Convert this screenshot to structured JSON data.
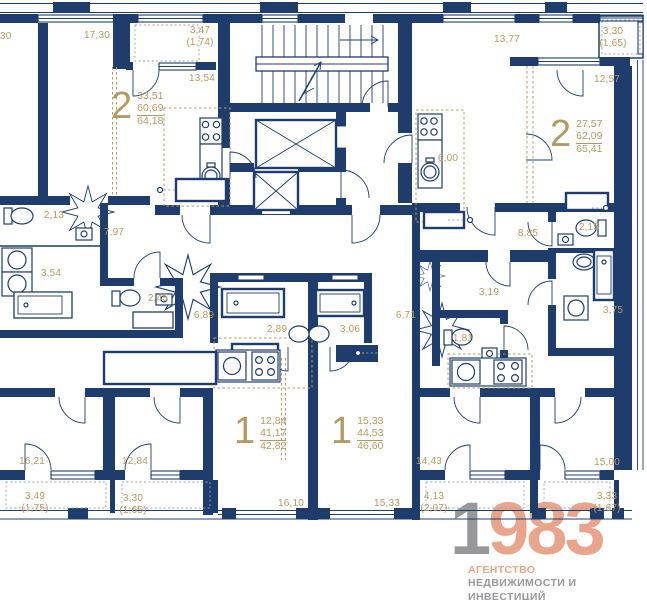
{
  "colors": {
    "wall": "#1e3c6c",
    "dim_label": "#b49a62",
    "logo_accent": "#e9a58c",
    "logo_gray": "#98989a"
  },
  "apartments": [
    {
      "rooms": "2",
      "living": "33,51",
      "area": "60,69",
      "total": "64,18"
    },
    {
      "rooms": "2",
      "living": "27,57",
      "area": "62,09",
      "total": "65,41"
    },
    {
      "rooms": "1",
      "living": "12,84",
      "area": "41,17",
      "total": "42,82"
    },
    {
      "rooms": "1",
      "living": "15,33",
      "area": "44,53",
      "total": "46,60"
    }
  ],
  "dims": [
    {
      "t": "30"
    },
    {
      "t": "17,30"
    },
    {
      "t": "3,47"
    },
    {
      "t": "(1,74)"
    },
    {
      "t": "13,54"
    },
    {
      "t": "13,77"
    },
    {
      "t": "3,30"
    },
    {
      "t": "(1,65)"
    },
    {
      "t": "12,57"
    },
    {
      "t": "6,00"
    },
    {
      "t": "2,13"
    },
    {
      "t": "7,97"
    },
    {
      "t": "3,54"
    },
    {
      "t": "2,45"
    },
    {
      "t": "6,89"
    },
    {
      "t": "2,89"
    },
    {
      "t": "3,06"
    },
    {
      "t": "6,71"
    },
    {
      "t": "8,85"
    },
    {
      "t": "2,15"
    },
    {
      "t": "3,19"
    },
    {
      "t": "1,81"
    },
    {
      "t": "3,75"
    },
    {
      "t": "16,21"
    },
    {
      "t": "12,84"
    },
    {
      "t": "3,49"
    },
    {
      "t": "(1,75)"
    },
    {
      "t": "3,30"
    },
    {
      "t": "(1,65)"
    },
    {
      "t": "16,10"
    },
    {
      "t": "15,33"
    },
    {
      "t": "14,43"
    },
    {
      "t": "4,13"
    },
    {
      "t": "(2,07)"
    },
    {
      "t": "15,00"
    },
    {
      "t": "3,33"
    },
    {
      "t": "(1,67)"
    }
  ],
  "logo": {
    "digit_gray": "1",
    "digits_accent": "983",
    "line1": "АГЕНТСТВО",
    "line2": "НЕДВИЖИМОСТИ И ИНВЕСТИЦИЙ"
  }
}
